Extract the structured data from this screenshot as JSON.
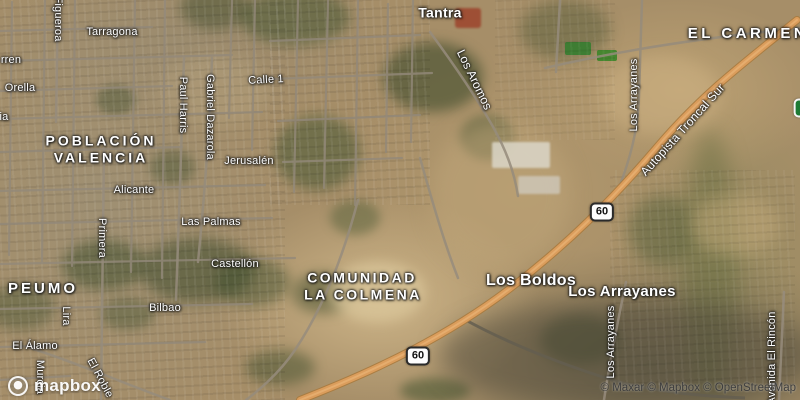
{
  "map": {
    "watermark": {
      "logo_text": "mapbox"
    },
    "attribution": {
      "text": "© Maxar © Mapbox © OpenStreetMap"
    },
    "colors": {
      "highway": "#db9d5c",
      "street": "#93897a",
      "shield_green": "#1d7a34",
      "shield_white": "#fdfdfd",
      "label": "#ffffff"
    },
    "shields": [
      {
        "name": "route-60-shield-west",
        "label": "60",
        "x": 418,
        "y": 356,
        "style": "white"
      },
      {
        "name": "route-60-shield-east",
        "label": "60",
        "x": 602,
        "y": 212,
        "style": "white"
      },
      {
        "name": "route-shield-green-edge",
        "label": "F",
        "x": 803,
        "y": 108,
        "style": "green"
      }
    ],
    "labels": [
      {
        "name": "map-label-el-carmen",
        "text": "EL CARMEN",
        "x": 748,
        "y": 34,
        "cls": "place",
        "fs": 15,
        "ls": 3.5
      },
      {
        "name": "map-label-poblacion",
        "text": "POBLACIÓN",
        "x": 101,
        "y": 141,
        "cls": "place",
        "fs": 14
      },
      {
        "name": "map-label-valencia",
        "text": "VALENCIA",
        "x": 101,
        "y": 158,
        "cls": "place",
        "fs": 14
      },
      {
        "name": "map-label-el-peumo",
        "text": "EL PEUMO",
        "x": 27,
        "y": 289,
        "cls": "place",
        "fs": 15,
        "ls": 3
      },
      {
        "name": "map-label-comunidad",
        "text": "COMUNIDAD",
        "x": 362,
        "y": 278,
        "cls": "place",
        "fs": 14,
        "ls": 2.5
      },
      {
        "name": "map-label-la-colmena",
        "text": "LA COLMENA",
        "x": 363,
        "y": 295,
        "cls": "place",
        "fs": 14,
        "ls": 2.5
      },
      {
        "name": "map-label-tantra",
        "text": "Tantra",
        "x": 440,
        "y": 13,
        "cls": "town",
        "fs": 14
      },
      {
        "name": "map-label-los-boldos",
        "text": "Los Boldos",
        "x": 531,
        "y": 281,
        "cls": "town",
        "fs": 16
      },
      {
        "name": "map-label-los-arrayanes-town",
        "text": "Los Arrayanes",
        "x": 622,
        "y": 292,
        "cls": "town",
        "fs": 15
      },
      {
        "name": "map-label-tarragona",
        "text": "Tarragona",
        "x": 112,
        "y": 32,
        "cls": "street"
      },
      {
        "name": "map-label-rren-partial",
        "text": "rren",
        "x": 11,
        "y": 60,
        "cls": "street"
      },
      {
        "name": "map-label-orella",
        "text": "Orella",
        "x": 20,
        "y": 88,
        "cls": "street"
      },
      {
        "name": "map-label-ia-partial",
        "text": "ia",
        "x": 4,
        "y": 117,
        "cls": "street"
      },
      {
        "name": "map-label-calle-1",
        "text": "Calle 1",
        "x": 266,
        "y": 80,
        "cls": "street",
        "rot": -3
      },
      {
        "name": "map-label-jerusalen",
        "text": "Jerusalén",
        "x": 249,
        "y": 161,
        "cls": "street"
      },
      {
        "name": "map-label-alicante",
        "text": "Alicante",
        "x": 134,
        "y": 190,
        "cls": "street"
      },
      {
        "name": "map-label-las-palmas",
        "text": "Las Palmas",
        "x": 211,
        "y": 222,
        "cls": "street"
      },
      {
        "name": "map-label-castellon",
        "text": "Castellón",
        "x": 235,
        "y": 264,
        "cls": "street"
      },
      {
        "name": "map-label-bilbao",
        "text": "Bilbao",
        "x": 165,
        "y": 308,
        "cls": "street"
      },
      {
        "name": "map-label-el-alamo",
        "text": "El Álamo",
        "x": 35,
        "y": 346,
        "cls": "street"
      },
      {
        "name": "map-label-figueroa",
        "text": "Figueroa",
        "x": 58,
        "y": 19,
        "cls": "street",
        "rot": 90
      },
      {
        "name": "map-label-paul-harris",
        "text": "Paul Harris",
        "x": 183,
        "y": 105,
        "cls": "street",
        "rot": 90
      },
      {
        "name": "map-label-gabriel-dazarola",
        "text": "Gabriel Dazarola",
        "x": 210,
        "y": 117,
        "cls": "street",
        "rot": 90
      },
      {
        "name": "map-label-primera",
        "text": "Primera",
        "x": 102,
        "y": 238,
        "cls": "street",
        "rot": 90
      },
      {
        "name": "map-label-lira",
        "text": "Lira",
        "x": 66,
        "y": 316,
        "cls": "street",
        "rot": 90
      },
      {
        "name": "map-label-murcia",
        "text": "Murcia",
        "x": 40,
        "y": 377,
        "cls": "street",
        "rot": 90
      },
      {
        "name": "map-label-el-roble",
        "text": "El Roble",
        "x": 100,
        "y": 378,
        "cls": "street",
        "rot": 62
      },
      {
        "name": "map-label-los-aromos",
        "text": "Los Aromos",
        "x": 474,
        "y": 80,
        "cls": "street",
        "rot": 64,
        "fs": 12
      },
      {
        "name": "map-label-los-arrayanes-street-north",
        "text": "Los Arrayanes",
        "x": 634,
        "y": 95,
        "cls": "street",
        "rot": -90
      },
      {
        "name": "map-label-los-arrayanes-street-south",
        "text": "Los Arrayanes",
        "x": 611,
        "y": 342,
        "cls": "street",
        "rot": -90
      },
      {
        "name": "map-label-avenida-el-rincon",
        "text": "Avenida El Rincón",
        "x": 772,
        "y": 358,
        "cls": "street",
        "rot": -90
      },
      {
        "name": "map-label-autopista-troncal-sur",
        "text": "Autopista Troncal Sur",
        "x": 683,
        "y": 130,
        "cls": "street",
        "rot": -48,
        "fs": 12
      }
    ]
  }
}
